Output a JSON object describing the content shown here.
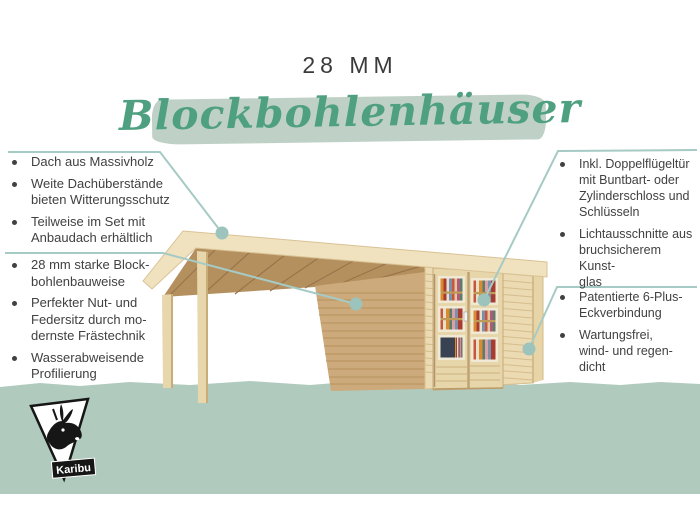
{
  "page": {
    "title": "28 MM",
    "headline": "Blockbohlenhäuser"
  },
  "features": {
    "left_top": {
      "items": [
        "Dach aus Massivholz",
        "Weite Dachüberstände\nbieten Witterungsschutz",
        "Teilweise im Set mit\nAnbaudach erhältlich"
      ]
    },
    "left_bottom": {
      "items": [
        "28 mm starke Block-\nbohlenbauweise",
        "Perfekter Nut- und\nFedersitz durch mo-\ndernste Frästechnik",
        "Wasserabweisende\nProfilierung"
      ]
    },
    "right_top": {
      "items": [
        "Inkl. Doppelflügeltür\nmit Buntbart- oder\nZylinderschloss und\nSchlüsseln",
        "Lichtausschnitte aus\nbruchsicherem Kunst-\nglas"
      ]
    },
    "right_bottom": {
      "items": [
        "Patentierte 6-Plus-\nEckverbindung",
        "Wartungsfrei,\nwind- und regen-\ndicht"
      ]
    }
  },
  "logo": {
    "brand": "Karibu"
  },
  "illustration": {
    "name": "blockbohlenhaus-mit-anbaudach-und-doppeltuer"
  },
  "colors": {
    "headline_green": "#4fa081",
    "brush_stroke": "#bfd1c6",
    "ground_band": "#b0cabe",
    "callout_teal": "#a6cac4",
    "callout_dot": "#9cc3bc",
    "text": "#414141",
    "wood_light": "#ebdab2",
    "wood_side": "#cdaa7b",
    "wood_rafter": "#b5905f",
    "roof_cream": "#f0e2bf"
  }
}
